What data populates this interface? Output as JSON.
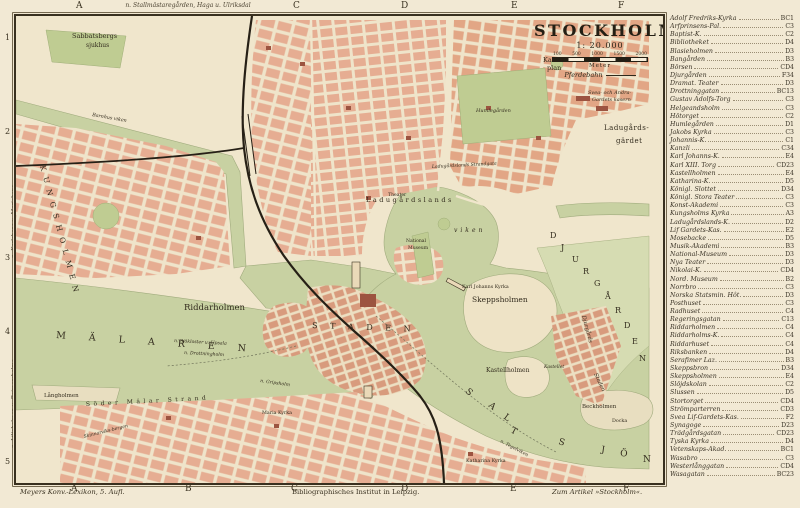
{
  "title_block": {
    "title": "STOCKHOLM",
    "scale": "1: 20.000",
    "scale_ticks": [
      "100",
      "500",
      "1000",
      "1500",
      "2000"
    ],
    "scale_unit": "Meter",
    "legend_pferdebahn": "Pferdebahn"
  },
  "margins": {
    "top_letters": [
      {
        "t": "A",
        "x": 76
      },
      {
        "t": "C",
        "x": 293
      },
      {
        "t": "D",
        "x": 401
      },
      {
        "t": "E",
        "x": 511
      },
      {
        "t": "F",
        "x": 618
      }
    ],
    "bottom_letters": [
      {
        "t": "A",
        "x": 71
      },
      {
        "t": "B",
        "x": 185
      },
      {
        "t": "C",
        "x": 291
      },
      {
        "t": "D",
        "x": 401
      },
      {
        "t": "E",
        "x": 510
      },
      {
        "t": "F",
        "x": 623
      }
    ],
    "left_numbers": [
      {
        "t": "1",
        "y": 38
      },
      {
        "t": "2",
        "y": 132
      },
      {
        "t": "3",
        "y": 258
      },
      {
        "t": "4",
        "y": 332
      },
      {
        "t": "5",
        "y": 462
      }
    ],
    "top_route": "n. Stallmästaregården, Haga u. Ulriksdal",
    "left_route_upper": "n. Karlsberg u. Marieberg",
    "left_route_lower": "n. Liljeholmen u. Reimersholme"
  },
  "captions": {
    "bottom_left": "Meyers Konv.-Lexikon, 5. Aufl.",
    "bottom_center": "Bibliographisches Institut in Leipzig.",
    "bottom_right": "Zum Artikel »Stockholm«."
  },
  "index": {
    "entries": [
      {
        "name": "Adolf Fredriks-Kyrka",
        "ref": "BC1"
      },
      {
        "name": "Arfprinsens-Pal.",
        "ref": "C3"
      },
      {
        "name": "Baptist-K.",
        "ref": "C2"
      },
      {
        "name": "Bibliotheket",
        "ref": "D4"
      },
      {
        "name": "Blasieholmen",
        "ref": "D3"
      },
      {
        "name": "Bangården",
        "ref": "B3"
      },
      {
        "name": "Börsen",
        "ref": "CD4"
      },
      {
        "name": "Djurgården",
        "ref": "F34"
      },
      {
        "name": "Dramat. Teater",
        "ref": "D3"
      },
      {
        "name": "Drottninggatan",
        "ref": "BC13"
      },
      {
        "name": "Gustav Adolfs-Torg",
        "ref": "C3"
      },
      {
        "name": "Helgeandsholm",
        "ref": "C3"
      },
      {
        "name": "Hötorget",
        "ref": "C2"
      },
      {
        "name": "Humlegården",
        "ref": "D1"
      },
      {
        "name": "Jakobs Kyrka",
        "ref": "C3"
      },
      {
        "name": "Johannis-K.",
        "ref": "C1"
      },
      {
        "name": "Kanzli",
        "ref": "C34"
      },
      {
        "name": "Karl Johanns-K.",
        "ref": "E4"
      },
      {
        "name": "Karl XIII. Torg",
        "ref": "CD23"
      },
      {
        "name": "Kastellholmen",
        "ref": "E4"
      },
      {
        "name": "Katharina-K.",
        "ref": "D5"
      },
      {
        "name": "Königl. Slottet",
        "ref": "D34"
      },
      {
        "name": "Königl. Stora Teater",
        "ref": "C3"
      },
      {
        "name": "Konst-Akademi",
        "ref": "C3"
      },
      {
        "name": "Kungsholms Kyrka",
        "ref": "A3"
      },
      {
        "name": "Ladugårdslands-K.",
        "ref": "D2"
      },
      {
        "name": "Lif Gardets-Kas.",
        "ref": "E2"
      },
      {
        "name": "Mosebacke",
        "ref": "D5"
      },
      {
        "name": "Musik-Akademi",
        "ref": "B3"
      },
      {
        "name": "National-Museum",
        "ref": "D3"
      },
      {
        "name": "Nya Teater",
        "ref": "D3"
      },
      {
        "name": "Nikolai-K.",
        "ref": "CD4"
      },
      {
        "name": "Nord. Museum",
        "ref": "B2"
      },
      {
        "name": "Norrbro",
        "ref": "C3"
      },
      {
        "name": "Norska Statsmin. Hôt.",
        "ref": "D3"
      },
      {
        "name": "Posthuset",
        "ref": "C3"
      },
      {
        "name": "Radhuset",
        "ref": "C4"
      },
      {
        "name": "Regeringsgatan",
        "ref": "C13"
      },
      {
        "name": "Riddarholmen",
        "ref": "C4"
      },
      {
        "name": "Riddarholms-K.",
        "ref": "C4"
      },
      {
        "name": "Riddarhuset",
        "ref": "C4"
      },
      {
        "name": "Riksbanken",
        "ref": "D4"
      },
      {
        "name": "Serafimer Laz.",
        "ref": "B3"
      },
      {
        "name": "Skeppsbron",
        "ref": "D34"
      },
      {
        "name": "Skeppsholmen",
        "ref": "E4"
      },
      {
        "name": "Slöjdskolan",
        "ref": "C2"
      },
      {
        "name": "Slussen",
        "ref": "D5"
      },
      {
        "name": "Stortorget",
        "ref": "CD4"
      },
      {
        "name": "Strömparterren",
        "ref": "CD3"
      },
      {
        "name": "Svea Lif-Gardets-Kas.",
        "ref": "F2"
      },
      {
        "name": "Synagoge",
        "ref": "D23"
      },
      {
        "name": "Trädgårdsgatan",
        "ref": "CD23"
      },
      {
        "name": "Tyska Kyrka",
        "ref": "D4"
      },
      {
        "name": "Vetenskaps-Akad.",
        "ref": "BC1"
      },
      {
        "name": "Wasabro",
        "ref": "C3"
      },
      {
        "name": "Westerlånggatan",
        "ref": "CD4"
      },
      {
        "name": "Wasagatan",
        "ref": "BC23"
      }
    ]
  },
  "map_labels": [
    {
      "t": "Sabbatsbergs",
      "x": 56,
      "y": 22,
      "s": 6.5
    },
    {
      "t": "sjukhus",
      "x": 70,
      "y": 31,
      "s": 6
    },
    {
      "t": "Karla",
      "x": 527,
      "y": 46,
      "s": 6.5
    },
    {
      "t": "plan",
      "x": 531,
      "y": 54,
      "s": 6.5
    },
    {
      "t": "Svea- och Andra-",
      "x": 572,
      "y": 78,
      "s": 5,
      "i": 1
    },
    {
      "t": "Gardets kasern",
      "x": 576,
      "y": 85,
      "s": 5,
      "i": 1
    },
    {
      "t": "Ladugårds-",
      "x": 588,
      "y": 114,
      "s": 7,
      "ls": 0.5
    },
    {
      "t": "gärdet",
      "x": 600,
      "y": 127,
      "s": 7,
      "ls": 0.5
    },
    {
      "t": "Ladugårdslands Strandgata",
      "x": 416,
      "y": 152,
      "s": 4.6,
      "r": -3,
      "i": 1
    },
    {
      "t": "Ladugårdslands",
      "x": 350,
      "y": 186,
      "s": 6.5,
      "ls": 2.5
    },
    {
      "t": "viken",
      "x": 438,
      "y": 216,
      "s": 6,
      "ls": 3,
      "i": 1
    },
    {
      "t": "Theater",
      "x": 372,
      "y": 180,
      "s": 4.6
    },
    {
      "t": "National",
      "x": 390,
      "y": 226,
      "s": 4.6
    },
    {
      "t": "Museum",
      "x": 392,
      "y": 233,
      "s": 4.6
    },
    {
      "t": "Karl Johanns Kyrka",
      "x": 446,
      "y": 272,
      "s": 4.8
    },
    {
      "t": "Skeppsholmen",
      "x": 456,
      "y": 286,
      "s": 7.5
    },
    {
      "t": "Kastellholmen",
      "x": 470,
      "y": 356,
      "s": 6
    },
    {
      "t": "Kastellet",
      "x": 528,
      "y": 352,
      "s": 4.5,
      "i": 1
    },
    {
      "t": "Riddarholmen",
      "x": 168,
      "y": 294,
      "s": 8.5
    },
    {
      "t": "Långholmen",
      "x": 28,
      "y": 381,
      "s": 5.5
    },
    {
      "t": "Söder Mälar Strand",
      "x": 70,
      "y": 390,
      "s": 6,
      "ls": 3.5,
      "r": -3
    },
    {
      "t": "Skinnarviks-bergen",
      "x": 68,
      "y": 422,
      "s": 4.6,
      "r": -14,
      "i": 1
    },
    {
      "t": "Maria Kyrka",
      "x": 246,
      "y": 398,
      "s": 4.8
    },
    {
      "t": "Katharina Kyrka",
      "x": 450,
      "y": 446,
      "s": 4.8
    },
    {
      "t": "Beckholmen",
      "x": 566,
      "y": 392,
      "s": 5.5
    },
    {
      "t": "Docka",
      "x": 596,
      "y": 406,
      "s": 4.8
    },
    {
      "t": "n. Tegelviken",
      "x": 484,
      "y": 426,
      "s": 4.6,
      "i": 1,
      "r": 28
    },
    {
      "t": "n. Sjökloster u. Upsala",
      "x": 158,
      "y": 326,
      "s": 4.6,
      "i": 1,
      "r": 3
    },
    {
      "t": "n. Drottningholm",
      "x": 168,
      "y": 338,
      "s": 4.6,
      "i": 1,
      "r": 3
    },
    {
      "t": "n. Gripsholm",
      "x": 244,
      "y": 366,
      "s": 4.6,
      "i": 1,
      "r": 8
    },
    {
      "t": "M Ä L A R E N",
      "x": 40,
      "y": 322,
      "s": 9.5,
      "ls": 10,
      "r": 4
    },
    {
      "t": "S T A D E N",
      "x": 296,
      "y": 312,
      "s": 8,
      "ls": 5,
      "r": 2
    },
    {
      "t": "Barnhus viken",
      "x": 76,
      "y": 100,
      "s": 4.8,
      "i": 1,
      "r": 10
    },
    {
      "t": "Humlegården",
      "x": 460,
      "y": 96,
      "s": 5,
      "i": 1
    },
    {
      "t": "K U N G S H O L M E N",
      "x": 24,
      "y": 150,
      "s": 7.5,
      "ls": 2,
      "r": 75
    },
    {
      "t": "Djurgårds",
      "x": 566,
      "y": 300,
      "s": 5.5,
      "i": 1,
      "r": 75
    },
    {
      "t": "Staden",
      "x": 578,
      "y": 358,
      "s": 5.5,
      "i": 1,
      "r": 65
    },
    {
      "t": "S",
      "x": 449,
      "y": 376,
      "s": 9,
      "r": 42
    },
    {
      "t": "A",
      "x": 472,
      "y": 390,
      "s": 9,
      "r": 40
    },
    {
      "t": "L",
      "x": 487,
      "y": 402,
      "s": 9,
      "r": 36
    },
    {
      "t": "T",
      "x": 494,
      "y": 416,
      "s": 9,
      "r": 28
    },
    {
      "t": "S",
      "x": 542,
      "y": 428,
      "s": 9,
      "r": 16
    },
    {
      "t": "J",
      "x": 585,
      "y": 436,
      "s": 9,
      "r": 8
    },
    {
      "t": "Ö",
      "x": 604,
      "y": 440,
      "s": 9,
      "r": 4
    },
    {
      "t": "N",
      "x": 627,
      "y": 446,
      "s": 9,
      "r": 0
    },
    {
      "t": "D",
      "x": 534,
      "y": 222,
      "s": 8
    },
    {
      "t": "J",
      "x": 545,
      "y": 234,
      "s": 8
    },
    {
      "t": "U",
      "x": 556,
      "y": 246,
      "s": 8
    },
    {
      "t": "R",
      "x": 567,
      "y": 258,
      "s": 8
    },
    {
      "t": "G",
      "x": 578,
      "y": 270,
      "s": 8
    },
    {
      "t": "Å",
      "x": 589,
      "y": 283,
      "s": 8
    },
    {
      "t": "R",
      "x": 599,
      "y": 297,
      "s": 8
    },
    {
      "t": "D",
      "x": 608,
      "y": 312,
      "s": 8
    },
    {
      "t": "E",
      "x": 616,
      "y": 328,
      "s": 8
    },
    {
      "t": "N",
      "x": 623,
      "y": 345,
      "s": 8
    }
  ],
  "colors": {
    "paper": "#f2e9d4",
    "map_land": "#f0e6cc",
    "water": "#c8d1a2",
    "park": "#bfcc92",
    "open_land": "#d6dcb2",
    "blocks": "#e6ad92",
    "blocks_dense": "#d89b7d",
    "ink": "#2c2619",
    "rail": "#262016"
  }
}
